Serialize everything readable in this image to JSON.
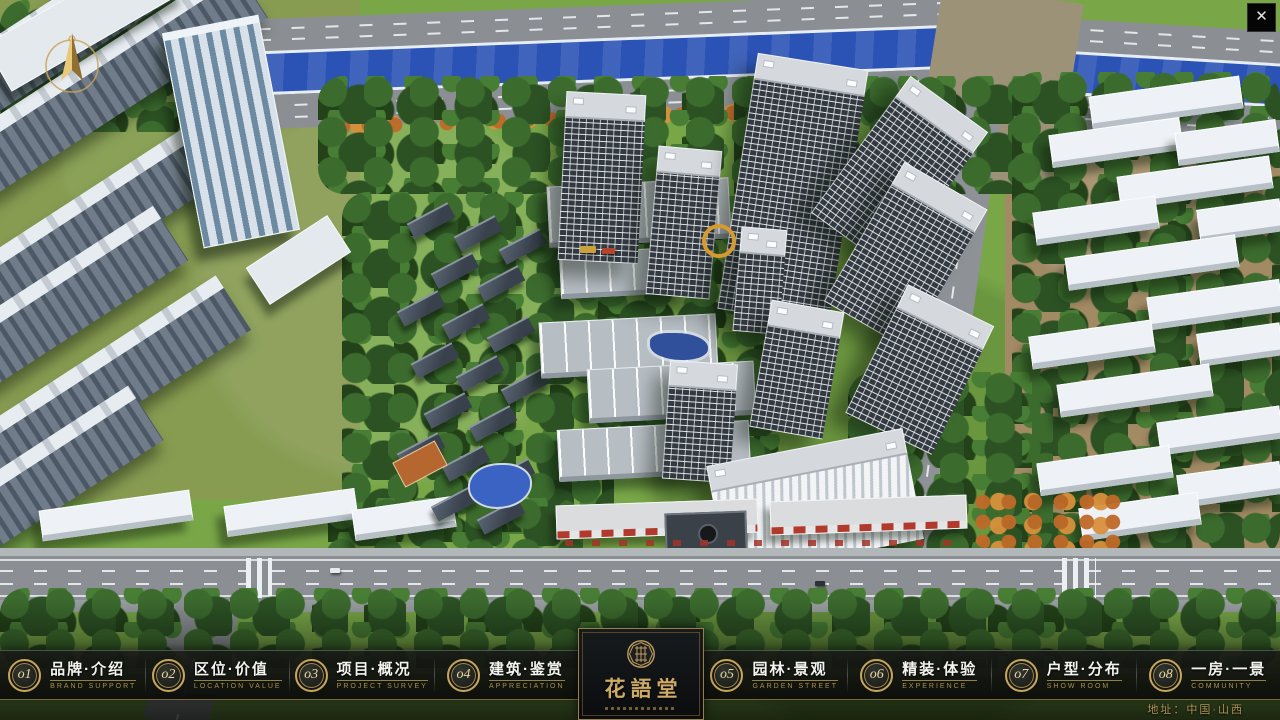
{
  "ui": {
    "close_icon": "✕",
    "address": "地址：中国·山西"
  },
  "menu": {
    "items": [
      {
        "num": "o1",
        "title": "品牌·介绍",
        "subtitle": "BRAND SUPPORT"
      },
      {
        "num": "o2",
        "title": "区位·价值",
        "subtitle": "LOCATION VALUE"
      },
      {
        "num": "o3",
        "title": "项目·概况",
        "subtitle": "PROJECT SURVEY"
      },
      {
        "num": "o4",
        "title": "建筑·鉴赏",
        "subtitle": "APPRECIATION"
      },
      {
        "num": "o5",
        "title": "园林·景观",
        "subtitle": "GARDEN STREET"
      },
      {
        "num": "o6",
        "title": "精装·体验",
        "subtitle": "EXPERIENCE"
      },
      {
        "num": "o7",
        "title": "户型·分布",
        "subtitle": "SHOW ROOM"
      },
      {
        "num": "o8",
        "title": "一房·一景",
        "subtitle": "COMMUNITY"
      }
    ]
  },
  "logo": {
    "title": "花語堂"
  },
  "colors": {
    "gold": "#c7a55f",
    "river": "#2b53b5",
    "grass": "#79a748",
    "bar": "#0d0f0c"
  }
}
